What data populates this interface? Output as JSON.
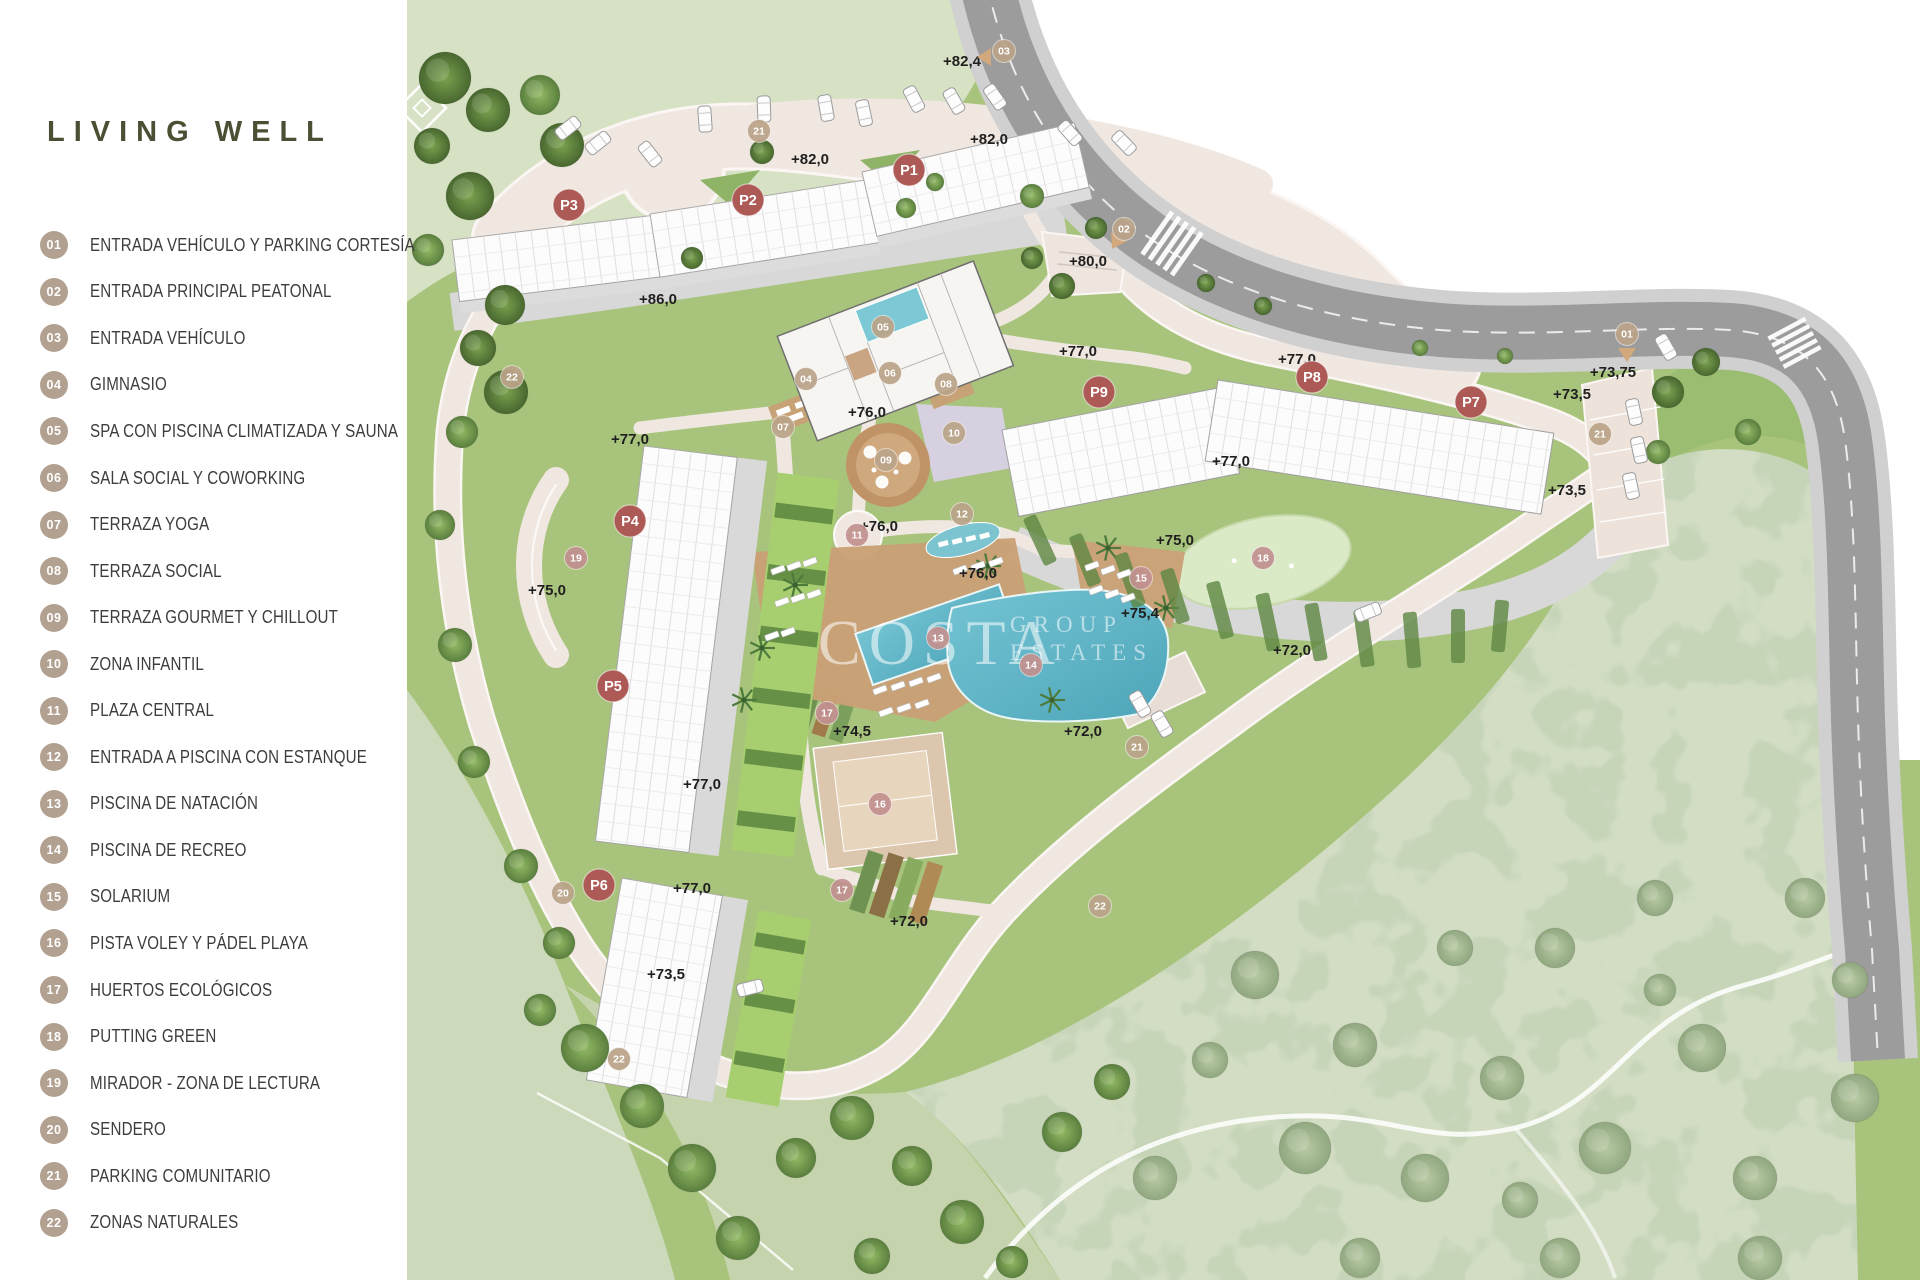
{
  "title": "LIVING WELL",
  "watermark": {
    "line1": "COSTA",
    "line2": "GROUP",
    "line3": "ESTATES"
  },
  "legend": [
    {
      "n": "01",
      "label": "ENTRADA VEHÍCULO Y PARKING CORTESÍA"
    },
    {
      "n": "02",
      "label": "ENTRADA PRINCIPAL PEATONAL"
    },
    {
      "n": "03",
      "label": "ENTRADA VEHÍCULO"
    },
    {
      "n": "04",
      "label": "GIMNASIO"
    },
    {
      "n": "05",
      "label": "SPA CON PISCINA CLIMATIZADA Y SAUNA"
    },
    {
      "n": "06",
      "label": "SALA SOCIAL Y COWORKING"
    },
    {
      "n": "07",
      "label": "TERRAZA YOGA"
    },
    {
      "n": "08",
      "label": "TERRAZA SOCIAL"
    },
    {
      "n": "09",
      "label": "TERRAZA GOURMET Y CHILLOUT"
    },
    {
      "n": "10",
      "label": "ZONA INFANTIL"
    },
    {
      "n": "11",
      "label": "PLAZA CENTRAL"
    },
    {
      "n": "12",
      "label": "ENTRADA A PISCINA CON ESTANQUE"
    },
    {
      "n": "13",
      "label": "PISCINA DE NATACIÓN"
    },
    {
      "n": "14",
      "label": "PISCINA DE RECREO"
    },
    {
      "n": "15",
      "label": "SOLARIUM"
    },
    {
      "n": "16",
      "label": "PISTA VOLEY Y PÁDEL PLAYA"
    },
    {
      "n": "17",
      "label": "HUERTOS ECOLÓGICOS"
    },
    {
      "n": "18",
      "label": "PUTTING GREEN"
    },
    {
      "n": "19",
      "label": "MIRADOR - ZONA DE LECTURA"
    },
    {
      "n": "20",
      "label": "SENDERO"
    },
    {
      "n": "21",
      "label": "PARKING COMUNITARIO"
    },
    {
      "n": "22",
      "label": "ZONAS NATURALES"
    }
  ],
  "map": {
    "colors": {
      "title": "#4a5033",
      "legend_circle": "#b2a190",
      "marker_building": "#ad5a56",
      "marker_tan": "#bba489",
      "marker_rose": "#c29190",
      "road": "#9c9c9c",
      "path": "#f0e7e1",
      "lawn": "#a8c47c",
      "field": "#d7e1c4",
      "natural": "#d2ddc3",
      "pool": "#57b5c7",
      "deck": "#c9a176"
    },
    "building_markers": [
      {
        "id": "P1",
        "x": 909,
        "y": 170
      },
      {
        "id": "P2",
        "x": 748,
        "y": 200
      },
      {
        "id": "P3",
        "x": 569,
        "y": 205
      },
      {
        "id": "P4",
        "x": 630,
        "y": 521
      },
      {
        "id": "P5",
        "x": 613,
        "y": 686
      },
      {
        "id": "P6",
        "x": 599,
        "y": 885
      },
      {
        "id": "P7",
        "x": 1471,
        "y": 402
      },
      {
        "id": "P8",
        "x": 1312,
        "y": 377
      },
      {
        "id": "P9",
        "x": 1099,
        "y": 392
      }
    ],
    "amenity_markers": [
      {
        "n": "01",
        "x": 1627,
        "y": 334,
        "c": "tan"
      },
      {
        "n": "02",
        "x": 1124,
        "y": 229,
        "c": "tan"
      },
      {
        "n": "03",
        "x": 1004,
        "y": 51,
        "c": "tan"
      },
      {
        "n": "04",
        "x": 806,
        "y": 379,
        "c": "tan"
      },
      {
        "n": "05",
        "x": 883,
        "y": 327,
        "c": "tan"
      },
      {
        "n": "06",
        "x": 890,
        "y": 373,
        "c": "tan"
      },
      {
        "n": "07",
        "x": 783,
        "y": 427,
        "c": "tan"
      },
      {
        "n": "08",
        "x": 946,
        "y": 384,
        "c": "tan"
      },
      {
        "n": "09",
        "x": 886,
        "y": 460,
        "c": "tan"
      },
      {
        "n": "10",
        "x": 954,
        "y": 433,
        "c": "tan"
      },
      {
        "n": "11",
        "x": 857,
        "y": 535,
        "c": "rose"
      },
      {
        "n": "12",
        "x": 962,
        "y": 514,
        "c": "tan"
      },
      {
        "n": "13",
        "x": 938,
        "y": 638,
        "c": "rose"
      },
      {
        "n": "14",
        "x": 1031,
        "y": 665,
        "c": "rose"
      },
      {
        "n": "15",
        "x": 1141,
        "y": 578,
        "c": "rose"
      },
      {
        "n": "16",
        "x": 880,
        "y": 804,
        "c": "rose"
      },
      {
        "n": "17",
        "x": 827,
        "y": 713,
        "c": "rose"
      },
      {
        "n": "17",
        "x": 842,
        "y": 890,
        "c": "rose"
      },
      {
        "n": "18",
        "x": 1263,
        "y": 558,
        "c": "rose"
      },
      {
        "n": "19",
        "x": 576,
        "y": 558,
        "c": "rose"
      },
      {
        "n": "20",
        "x": 563,
        "y": 893,
        "c": "tan"
      },
      {
        "n": "21",
        "x": 759,
        "y": 131,
        "c": "tan"
      },
      {
        "n": "21",
        "x": 1600,
        "y": 434,
        "c": "tan"
      },
      {
        "n": "21",
        "x": 1137,
        "y": 747,
        "c": "tan"
      },
      {
        "n": "22",
        "x": 512,
        "y": 377,
        "c": "tan"
      },
      {
        "n": "22",
        "x": 1100,
        "y": 906,
        "c": "tan"
      },
      {
        "n": "22",
        "x": 619,
        "y": 1059,
        "c": "tan"
      }
    ],
    "entry_arrows": [
      {
        "x": 985,
        "y": 57,
        "rot": 90
      },
      {
        "x": 1116,
        "y": 242,
        "rot": 30
      },
      {
        "x": 1627,
        "y": 354,
        "rot": 0
      }
    ],
    "elevation_labels": [
      [
        "+82,4",
        962,
        66
      ],
      [
        "+82,0",
        989,
        144
      ],
      [
        "+82,0",
        810,
        164
      ],
      [
        "+86,0",
        658,
        304
      ],
      [
        "+80,0",
        1088,
        266
      ],
      [
        "+77,0",
        1078,
        356
      ],
      [
        "+77,0",
        1297,
        364
      ],
      [
        "+76,0",
        867,
        417
      ],
      [
        "+77,0",
        630,
        444
      ],
      [
        "+77,0",
        1231,
        466
      ],
      [
        "+73,75",
        1613,
        377
      ],
      [
        "+73,5",
        1572,
        399
      ],
      [
        "+73,5",
        1567,
        495
      ],
      [
        "+76,0",
        879,
        531
      ],
      [
        "+76,0",
        978,
        578
      ],
      [
        "+75,0",
        1175,
        545
      ],
      [
        "+75,0",
        547,
        595
      ],
      [
        "+75,4",
        1140,
        618
      ],
      [
        "+72,0",
        1292,
        655
      ],
      [
        "+72,0",
        1083,
        736
      ],
      [
        "+74,5",
        852,
        736
      ],
      [
        "+77,0",
        702,
        789
      ],
      [
        "+77,0",
        692,
        893
      ],
      [
        "+72,0",
        909,
        926
      ],
      [
        "+73,5",
        666,
        979
      ]
    ],
    "trees": [
      [
        445,
        78,
        26,
        1
      ],
      [
        488,
        110,
        22,
        1
      ],
      [
        432,
        146,
        18,
        1
      ],
      [
        540,
        95,
        20,
        0
      ],
      [
        562,
        145,
        22,
        1
      ],
      [
        470,
        196,
        24,
        1
      ],
      [
        428,
        250,
        16,
        0
      ],
      [
        505,
        305,
        20,
        1
      ],
      [
        478,
        348,
        18,
        1
      ],
      [
        506,
        392,
        22,
        1
      ],
      [
        462,
        432,
        16,
        0
      ],
      [
        440,
        525,
        15,
        0
      ],
      [
        455,
        645,
        17,
        0
      ],
      [
        474,
        762,
        16,
        0
      ],
      [
        521,
        866,
        17,
        0
      ],
      [
        559,
        943,
        16,
        0
      ],
      [
        762,
        152,
        12,
        1
      ],
      [
        692,
        258,
        11,
        1
      ],
      [
        906,
        208,
        10,
        0
      ],
      [
        1032,
        196,
        12,
        0
      ],
      [
        1096,
        228,
        11,
        1
      ],
      [
        1062,
        286,
        13,
        1
      ],
      [
        1032,
        258,
        11,
        1
      ],
      [
        935,
        182,
        9,
        0
      ],
      [
        1206,
        283,
        9,
        1
      ],
      [
        1263,
        306,
        9,
        1
      ],
      [
        1420,
        348,
        8,
        0
      ],
      [
        1505,
        356,
        8,
        0
      ],
      [
        1668,
        392,
        16,
        1
      ],
      [
        1706,
        362,
        14,
        1
      ],
      [
        1748,
        432,
        13,
        0
      ],
      [
        1658,
        452,
        12,
        0
      ],
      [
        585,
        1048,
        24,
        0
      ],
      [
        642,
        1106,
        22,
        0
      ],
      [
        692,
        1168,
        24,
        0
      ],
      [
        738,
        1238,
        22,
        0
      ],
      [
        796,
        1158,
        20,
        0
      ],
      [
        852,
        1118,
        22,
        0
      ],
      [
        912,
        1166,
        20,
        0
      ],
      [
        962,
        1222,
        22,
        0
      ],
      [
        1062,
        1132,
        20,
        0
      ],
      [
        1112,
        1082,
        18,
        0
      ],
      [
        872,
        1256,
        18,
        0
      ],
      [
        1012,
        1262,
        16,
        0
      ],
      [
        540,
        1010,
        16,
        0
      ],
      [
        1255,
        975,
        24,
        2
      ],
      [
        1355,
        1045,
        22,
        2
      ],
      [
        1305,
        1148,
        26,
        2
      ],
      [
        1425,
        1178,
        24,
        2
      ],
      [
        1502,
        1078,
        22,
        2
      ],
      [
        1605,
        1148,
        26,
        2
      ],
      [
        1702,
        1048,
        24,
        2
      ],
      [
        1755,
        1178,
        22,
        2
      ],
      [
        1555,
        948,
        20,
        2
      ],
      [
        1655,
        898,
        18,
        2
      ],
      [
        1805,
        898,
        20,
        2
      ],
      [
        1855,
        1098,
        24,
        2
      ],
      [
        1455,
        948,
        18,
        2
      ],
      [
        1155,
        1178,
        22,
        2
      ],
      [
        1760,
        1258,
        22,
        2
      ],
      [
        1560,
        1258,
        20,
        2
      ],
      [
        1360,
        1258,
        20,
        2
      ],
      [
        1660,
        990,
        16,
        2
      ],
      [
        1850,
        980,
        18,
        2
      ],
      [
        1210,
        1060,
        18,
        2
      ],
      [
        1520,
        1200,
        18,
        2
      ]
    ],
    "palms": [
      [
        795,
        585
      ],
      [
        762,
        648
      ],
      [
        988,
        566
      ],
      [
        1108,
        548
      ],
      [
        1166,
        608
      ],
      [
        744,
        700
      ],
      [
        1052,
        700
      ]
    ],
    "cars": [
      [
        568,
        128,
        -38
      ],
      [
        598,
        143,
        -38
      ],
      [
        650,
        154,
        52
      ],
      [
        705,
        119,
        86
      ],
      [
        764,
        109,
        88
      ],
      [
        826,
        108,
        80
      ],
      [
        864,
        113,
        78
      ],
      [
        914,
        99,
        62
      ],
      [
        954,
        101,
        60
      ],
      [
        995,
        97,
        55
      ],
      [
        1070,
        133,
        48
      ],
      [
        1124,
        143,
        46
      ],
      [
        1666,
        347,
        60
      ],
      [
        1634,
        412,
        78
      ],
      [
        1639,
        450,
        78
      ],
      [
        1631,
        486,
        78
      ],
      [
        1368,
        612,
        -22
      ],
      [
        1140,
        704,
        60
      ],
      [
        1162,
        724,
        60
      ],
      [
        750,
        988,
        -14
      ]
    ],
    "loungers": [
      [
        778,
        570
      ],
      [
        794,
        566
      ],
      [
        810,
        562
      ],
      [
        782,
        602
      ],
      [
        798,
        598
      ],
      [
        814,
        594
      ],
      [
        772,
        636
      ],
      [
        788,
        632
      ],
      [
        880,
        690
      ],
      [
        898,
        686
      ],
      [
        916,
        682
      ],
      [
        934,
        678
      ],
      [
        886,
        712
      ],
      [
        904,
        708
      ],
      [
        922,
        704
      ],
      [
        1092,
        566
      ],
      [
        1108,
        570
      ],
      [
        1124,
        574
      ],
      [
        1096,
        590
      ],
      [
        1112,
        594
      ],
      [
        1128,
        598
      ],
      [
        960,
        570
      ],
      [
        978,
        566
      ],
      [
        996,
        562
      ]
    ],
    "hedges": [
      [
        1040,
        540,
        14,
        52,
        -25
      ],
      [
        1085,
        560,
        14,
        54,
        -22
      ],
      [
        1130,
        580,
        14,
        56,
        -20
      ],
      [
        1175,
        596,
        14,
        56,
        -18
      ],
      [
        1220,
        610,
        14,
        58,
        -15
      ],
      [
        1268,
        622,
        14,
        58,
        -12
      ],
      [
        1316,
        632,
        14,
        58,
        -10
      ],
      [
        1364,
        638,
        14,
        58,
        -8
      ],
      [
        1412,
        640,
        14,
        56,
        -5
      ],
      [
        1458,
        636,
        14,
        54,
        0
      ],
      [
        1500,
        626,
        14,
        52,
        5
      ]
    ]
  }
}
